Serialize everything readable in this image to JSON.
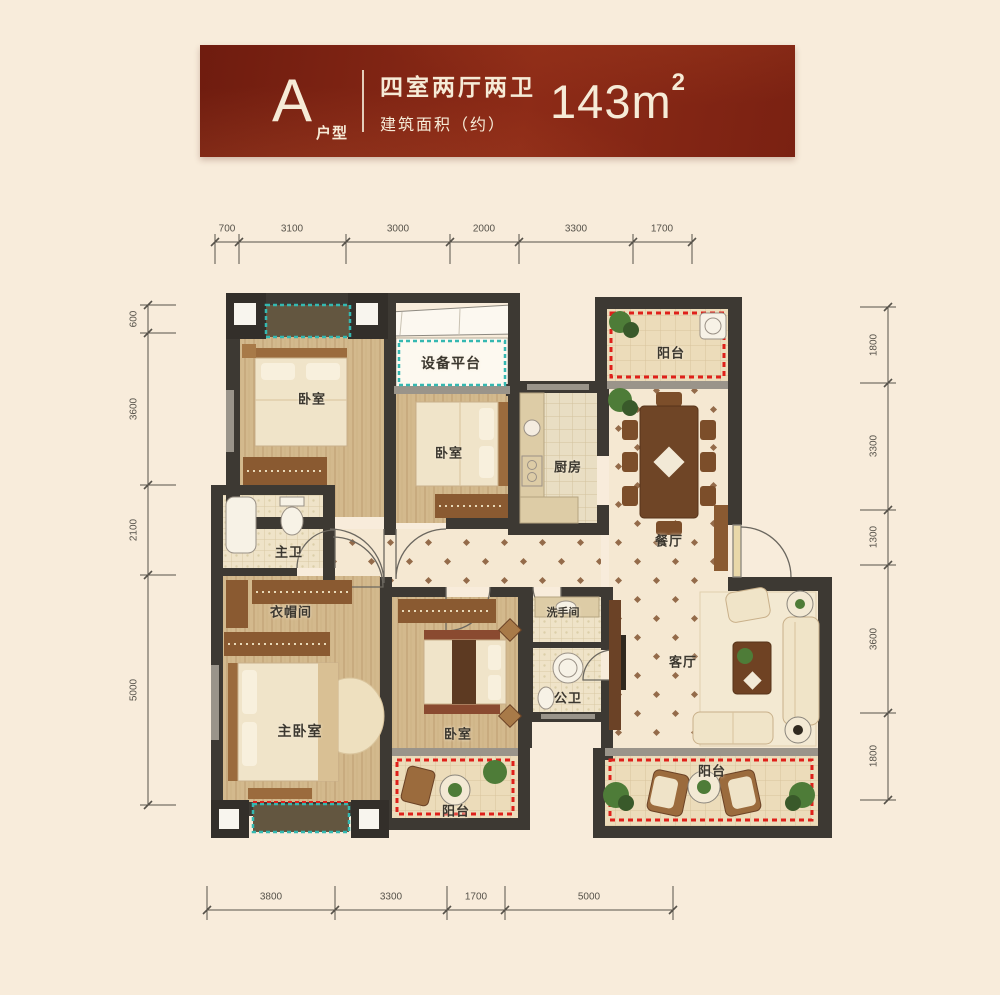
{
  "header": {
    "type_letter": "A",
    "type_label": "户型",
    "layout_line": "四室两厅两卫",
    "area_label": "建筑面积（约）",
    "area_value": "143m",
    "area_sup": "2"
  },
  "rooms": {
    "bedroom_top_left": "卧室",
    "equipment_platform": "设备平台",
    "bedroom_top_middle": "卧室",
    "balcony_top": "阳台",
    "kitchen": "厨房",
    "dining_room": "餐厅",
    "master_bathroom": "主卫",
    "cloakroom": "衣帽间",
    "master_bedroom": "主卧室",
    "bedroom_bottom": "卧室",
    "washroom": "洗手间",
    "guest_bathroom": "公卫",
    "living_room": "客厅",
    "balcony_bottom_middle": "阳台",
    "balcony_bottom_right": "阳台"
  },
  "dimensions": {
    "top": [
      "700",
      "3100",
      "3000",
      "2000",
      "3300",
      "1700"
    ],
    "left": [
      "600",
      "3600",
      "2100",
      "5000"
    ],
    "right": [
      "1800",
      "3300",
      "1300",
      "3600",
      "1800"
    ],
    "bottom": [
      "3800",
      "3300",
      "1700",
      "5000"
    ]
  },
  "colors": {
    "background": "#f8ecdb",
    "banner_red": "#7b2012",
    "banner_text": "#f6ebd7",
    "wall": "#3d3933",
    "balcony_dash_red": "#df201a",
    "platform_dash_cyan": "#35b8b1",
    "wood_floor": "#d3b98d",
    "tile_floor": "#f5e8d2"
  }
}
